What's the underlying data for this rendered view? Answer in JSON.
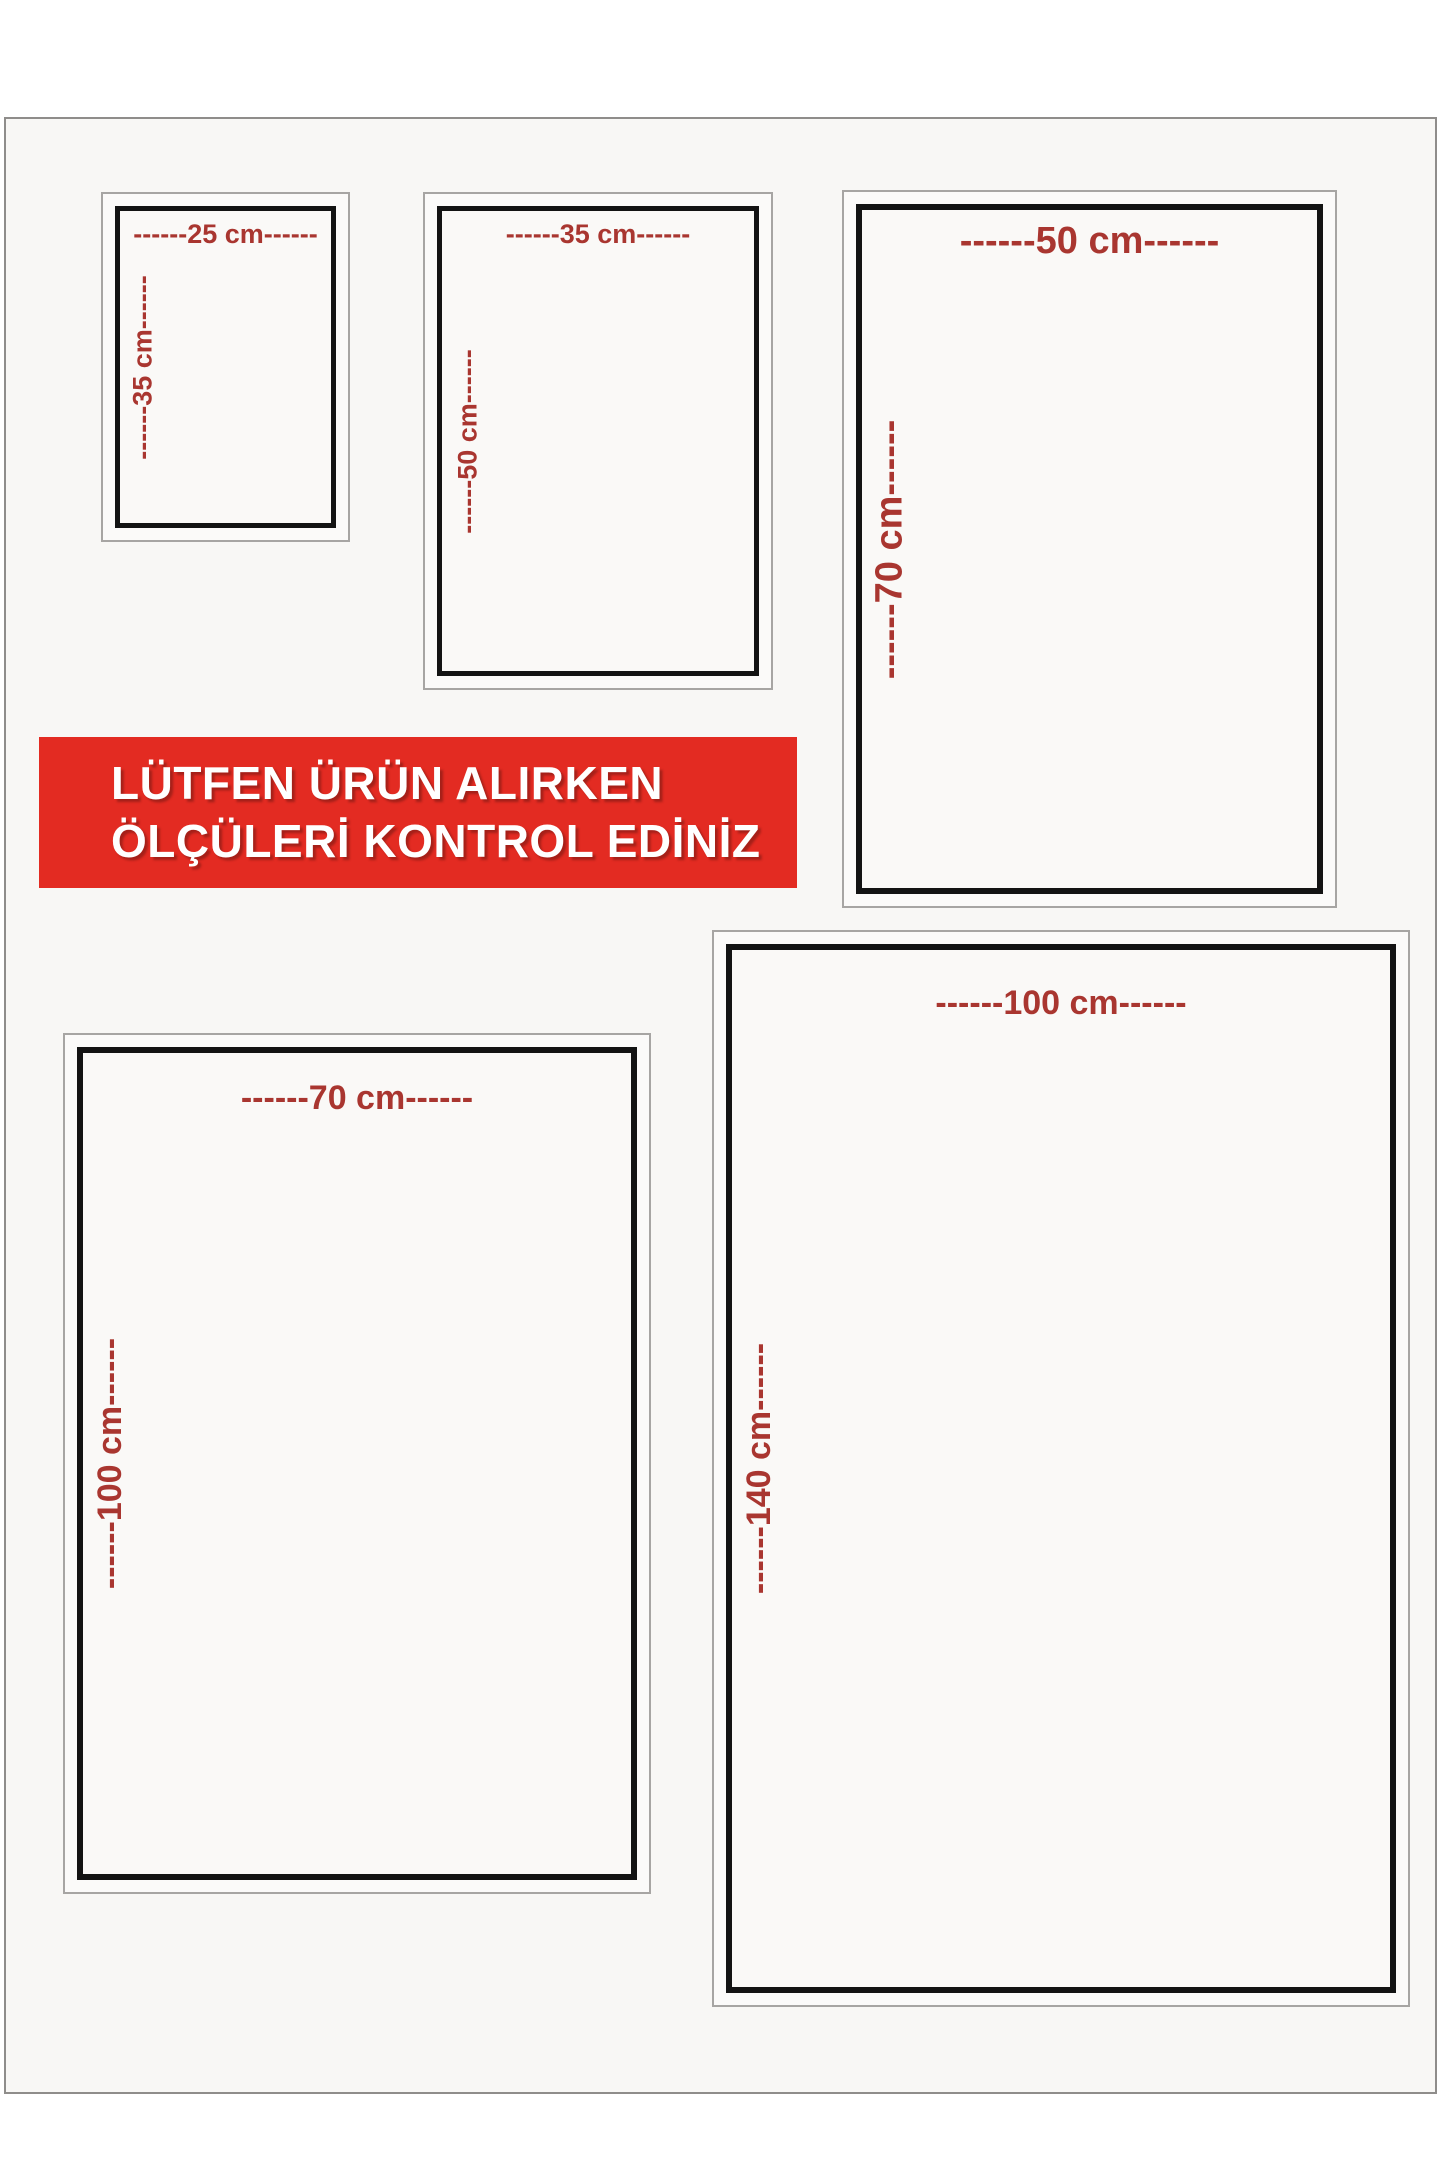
{
  "banner": {
    "line1": "LÜTFEN ÜRÜN ALIRKEN",
    "line2": "ÖLÇÜLERİ KONTROL EDİNİZ",
    "background": "#e32b22",
    "text_color": "#ffffff"
  },
  "colors": {
    "dimension_text": "#a93630",
    "box_border_black": "#131313",
    "frame_outline_gray": "#a7a5a3",
    "page_background": "#f8f7f5",
    "outer_background": "#ffffff"
  },
  "sizes": [
    {
      "name": "25x35",
      "width_cm": 25,
      "height_cm": 35,
      "width_label": "------25 cm------",
      "height_label": "------35 cm------"
    },
    {
      "name": "35x50",
      "width_cm": 35,
      "height_cm": 50,
      "width_label": "------35 cm------",
      "height_label": "------50 cm------"
    },
    {
      "name": "50x70",
      "width_cm": 50,
      "height_cm": 70,
      "width_label": "------50 cm------",
      "height_label": "------70 cm------"
    },
    {
      "name": "70x100",
      "width_cm": 70,
      "height_cm": 100,
      "width_label": "------70 cm------",
      "height_label": "------100 cm------"
    },
    {
      "name": "100x140",
      "width_cm": 100,
      "height_cm": 140,
      "width_label": "------100 cm------",
      "height_label": "------140 cm------"
    }
  ]
}
